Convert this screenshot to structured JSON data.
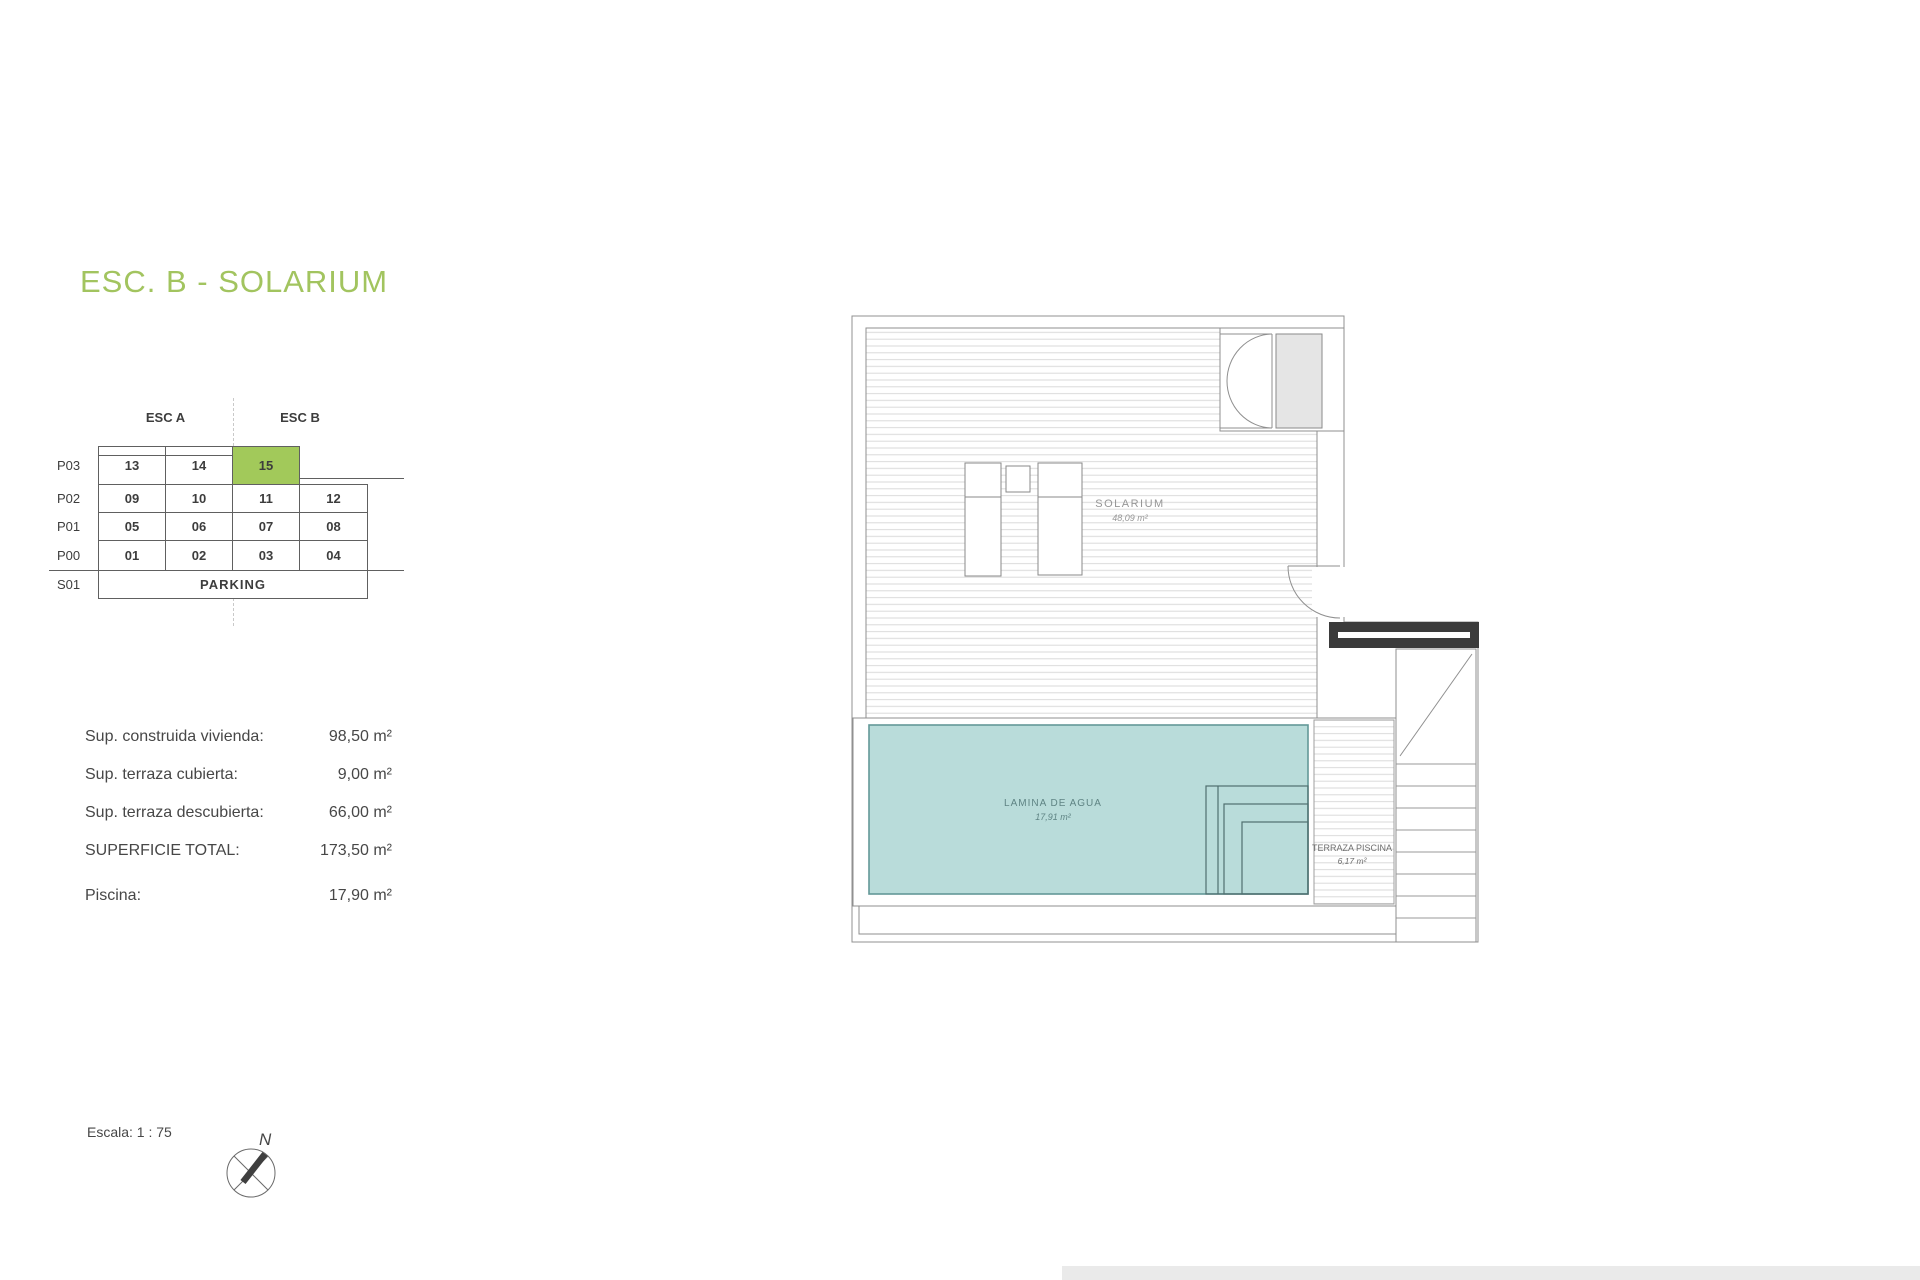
{
  "page": {
    "title": "ESC. B - SOLARIUM"
  },
  "unit_grid": {
    "headers": [
      "ESC A",
      "ESC B"
    ],
    "rows": [
      {
        "level": "P03",
        "units": [
          "13",
          "14",
          "15"
        ],
        "highlighted_unit": "15"
      },
      {
        "level": "P02",
        "units": [
          "09",
          "10",
          "11",
          "12"
        ]
      },
      {
        "level": "P01",
        "units": [
          "05",
          "06",
          "07",
          "08"
        ]
      },
      {
        "level": "P00",
        "units": [
          "01",
          "02",
          "03",
          "04"
        ]
      },
      {
        "level": "S01",
        "units": [
          "PARKING"
        ]
      }
    ],
    "highlight_color": "#a2c95a"
  },
  "measurements": {
    "rows": [
      {
        "label": "Sup. construida vivienda:",
        "value": "98,50 m²"
      },
      {
        "label": "Sup. terraza cubierta:",
        "value": "9,00 m²"
      },
      {
        "label": "Sup. terraza descubierta:",
        "value": "66,00 m²"
      },
      {
        "label": "SUPERFICIE TOTAL:",
        "value": "173,50 m²"
      },
      {
        "label": "Piscina:",
        "value": "17,90 m²"
      }
    ]
  },
  "floor_plan": {
    "rooms": [
      {
        "name": "SOLARIUM",
        "area": "48,09 m²"
      },
      {
        "name": "LAMINA DE AGUA",
        "area": "17,91 m²"
      },
      {
        "name": "TERRAZA PISCINA",
        "area": "6,17 m²"
      }
    ],
    "pool_color": "#b9dcda"
  },
  "footer": {
    "scale_label": "Escala: 1 : 75",
    "compass_letter": "N"
  }
}
